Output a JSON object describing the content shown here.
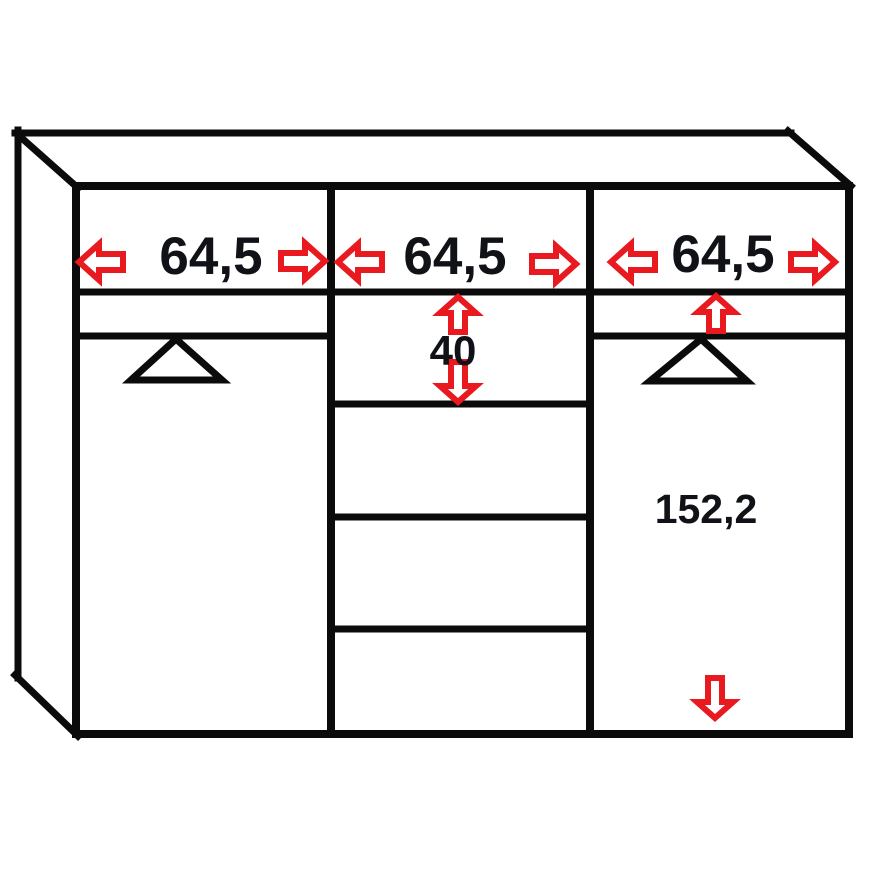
{
  "diagram": {
    "kind": "wardrobe-dimension-drawing",
    "background": "#ffffff",
    "colors": {
      "line": "#0b0b0b",
      "accent_red": "#e8191f",
      "text": "#101218",
      "arrow_fill": "#ffffff"
    },
    "cabinet": {
      "sections": [
        {
          "id": "left",
          "width_label": "64,5",
          "width_arrows": [
            "arrow-left",
            "arrow-right"
          ],
          "symbol": "door-triangle"
        },
        {
          "id": "middle",
          "width_label": "64,5",
          "width_arrows": [
            "arrow-left",
            "arrow-right"
          ],
          "top_drawer_height_label": "40",
          "height_arrows": [
            "arrow-up",
            "arrow-down"
          ],
          "drawer_count": 4
        },
        {
          "id": "right",
          "width_label": "64,5",
          "width_arrows": [
            "arrow-left",
            "arrow-right"
          ],
          "height_label": "152,2",
          "height_arrows": [
            "arrow-up",
            "arrow-down"
          ],
          "symbol": "door-triangle"
        }
      ]
    }
  }
}
